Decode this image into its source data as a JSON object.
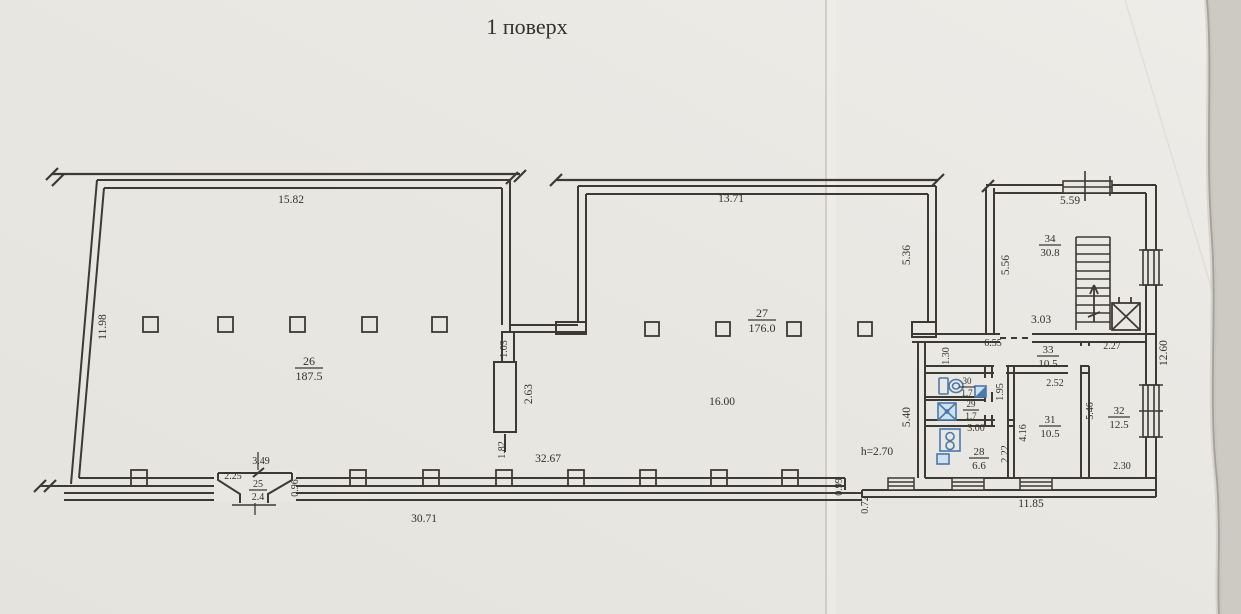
{
  "title": "1 поверх",
  "colors": {
    "paper": "#e9e7e2",
    "paper_light": "#edebe6",
    "ink": "#3c3a33",
    "fixture_blue": "#4a79ad",
    "fixture_fill": "#cfe0ee",
    "note_blue": "#3f5d9b",
    "edge_shadow": "#a5a19a",
    "outside": "#cdcac4"
  },
  "floor": {
    "note": "h=2.70",
    "rooms": [
      {
        "number": "26",
        "area": "187.5",
        "x": 309,
        "y": 368,
        "fs": 12,
        "bw": 14
      },
      {
        "number": "27",
        "area": "176.0",
        "x": 762,
        "y": 320,
        "fs": 12,
        "bw": 14
      },
      {
        "number": "34",
        "area": "30.8",
        "x": 1050,
        "y": 245,
        "fs": 11,
        "bw": 11
      },
      {
        "number": "33",
        "area": "10.5",
        "x": 1048,
        "y": 356,
        "fs": 11,
        "bw": 11
      },
      {
        "number": "30",
        "area": "1.7",
        "x": 967,
        "y": 387,
        "fs": 9,
        "bw": 8
      },
      {
        "number": "29",
        "area": "1.7",
        "x": 971,
        "y": 410,
        "fs": 9,
        "bw": 8
      },
      {
        "number": "28",
        "area": "6.6",
        "x": 979,
        "y": 458,
        "fs": 11,
        "bw": 10
      },
      {
        "number": "31",
        "area": "10.5",
        "x": 1050,
        "y": 426,
        "fs": 11,
        "bw": 11
      },
      {
        "number": "32",
        "area": "12.5",
        "x": 1119,
        "y": 417,
        "fs": 11,
        "bw": 11
      },
      {
        "number": "25",
        "area": "2.4",
        "x": 258,
        "y": 490,
        "fs": 10,
        "bw": 9
      }
    ],
    "dims": [
      {
        "t": "15.82",
        "x": 291,
        "y": 203
      },
      {
        "t": "11.98",
        "x": 106,
        "y": 327,
        "r": -90
      },
      {
        "t": "13.71",
        "x": 731,
        "y": 202
      },
      {
        "t": "1.03",
        "x": 507,
        "y": 349,
        "r": -90,
        "fs": 10
      },
      {
        "t": "2.63",
        "x": 532,
        "y": 394,
        "r": -90
      },
      {
        "t": "1.82",
        "x": 505,
        "y": 450,
        "r": -90,
        "fs": 10
      },
      {
        "t": "32.67",
        "x": 548,
        "y": 462
      },
      {
        "t": "16.00",
        "x": 722,
        "y": 405
      },
      {
        "t": "5.36",
        "x": 910,
        "y": 255,
        "r": -90
      },
      {
        "t": "5.56",
        "x": 1009,
        "y": 265,
        "r": -90
      },
      {
        "t": "5.59",
        "x": 1070,
        "y": 204
      },
      {
        "t": "3.03",
        "x": 1041,
        "y": 323
      },
      {
        "t": "6.55",
        "x": 993,
        "y": 346,
        "fs": 10
      },
      {
        "t": "1.30",
        "x": 949,
        "y": 356,
        "r": -90,
        "fs": 10
      },
      {
        "t": "2.27",
        "x": 1112,
        "y": 349,
        "fs": 10
      },
      {
        "t": "12.60",
        "x": 1167,
        "y": 353,
        "r": -90
      },
      {
        "t": "1.95",
        "x": 1003,
        "y": 392,
        "r": -90,
        "fs": 10
      },
      {
        "t": "2.52",
        "x": 1055,
        "y": 386,
        "fs": 10
      },
      {
        "t": "3.00",
        "x": 976,
        "y": 431,
        "fs": 10
      },
      {
        "t": "4.16",
        "x": 1026,
        "y": 433,
        "r": -90,
        "fs": 10
      },
      {
        "t": "2.22",
        "x": 1008,
        "y": 454,
        "r": -90,
        "fs": 10
      },
      {
        "t": "5.46",
        "x": 1093,
        "y": 411,
        "r": -90,
        "fs": 10
      },
      {
        "t": "2.30",
        "x": 1122,
        "y": 469,
        "fs": 10
      },
      {
        "t": "5.40",
        "x": 910,
        "y": 417,
        "r": -90
      },
      {
        "t": "0.99",
        "x": 842,
        "y": 487,
        "r": -90,
        "fs": 10
      },
      {
        "t": "0.72",
        "x": 868,
        "y": 505,
        "r": -90,
        "fs": 10
      },
      {
        "t": "11.85",
        "x": 1031,
        "y": 507
      },
      {
        "t": "30.71",
        "x": 424,
        "y": 522
      },
      {
        "t": "3.49",
        "x": 261,
        "y": 464,
        "fs": 10
      },
      {
        "t": "2.25",
        "x": 233,
        "y": 479,
        "fs": 10
      },
      {
        "t": "0.96",
        "x": 298,
        "y": 488,
        "r": -90,
        "fs": 10
      },
      {
        "t": "h=2.70",
        "x": 877,
        "y": 455,
        "c": "blue"
      }
    ],
    "columns": {
      "hall26_x": [
        143,
        218,
        290,
        362,
        432
      ],
      "hall26_y": 317,
      "hall27_x": [
        645,
        716,
        787,
        858
      ],
      "hall27_y": 322,
      "size": 15
    },
    "pilasters_x": [
      139,
      358,
      431,
      504,
      576,
      648,
      719,
      790
    ]
  }
}
